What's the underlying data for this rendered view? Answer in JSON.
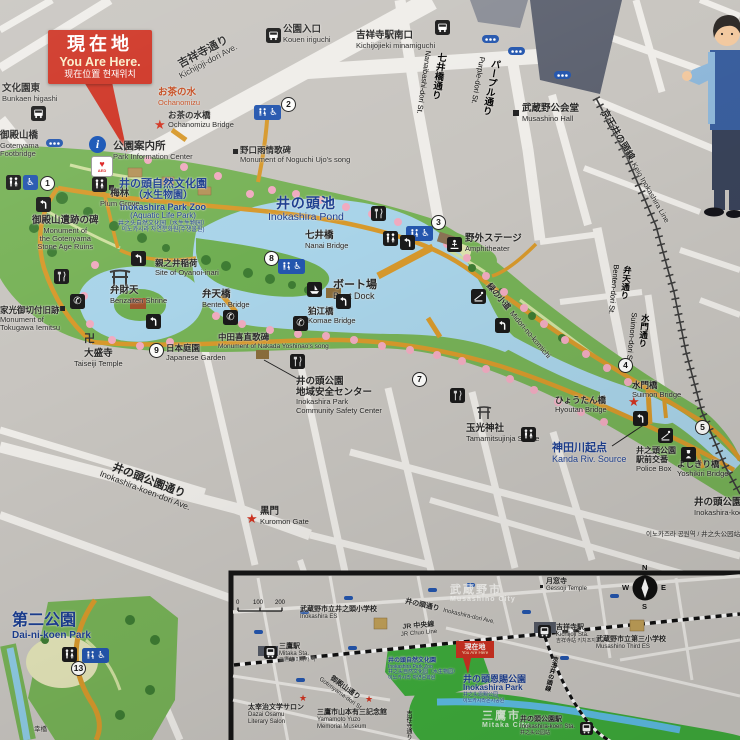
{
  "colors": {
    "background_gray": "#c8c5c0",
    "street_white": "#efede9",
    "park_green": "#77b257",
    "pond_blue": "#a9d4e9",
    "path_orange": "#d7992c",
    "accent_red": "#ce3222",
    "navy_text": "#1c3e90",
    "icon_blue": "#2456ae",
    "inset_green": "#3fae3c"
  },
  "you_are_here": {
    "ja": "現在地",
    "en": "You Are Here.",
    "sub": "现在位置  현재위치"
  },
  "icons": {
    "wheelchair": "♿",
    "info": "i",
    "phone": "✆",
    "star": "★",
    "manji": "卍",
    "heart": "♥",
    "aed_label": "AED"
  },
  "markers": {
    "n1": "1",
    "n2": "2",
    "n3": "3",
    "n4": "4",
    "n5": "5",
    "n7": "7",
    "n8": "8",
    "n9": "9",
    "n13": "13"
  },
  "labels": {
    "bunkaen_higashi": {
      "ja": "文化園東",
      "en": "Bunkaen higashi"
    },
    "kichijoji_dori": {
      "ja": "吉祥寺通り",
      "en": "Kichijoji-dori Ave."
    },
    "kouen_iriguchi": {
      "ja": "公園入口",
      "en": "Kouen iriguchi"
    },
    "kichijojieki_minamiguchi": {
      "ja": "吉祥寺駅南口",
      "en": "Kichijojieki minamiguchi"
    },
    "nanaibashi_dori": {
      "ja": "七井橋通り",
      "en": "Nanaibashi-dori St."
    },
    "purple_dori": {
      "ja": "パープル通り",
      "en": "Purple-dori St."
    },
    "musashino_hall": {
      "ja": "武蔵野公会堂",
      "en": "Musashino Hall"
    },
    "keio_line": {
      "ja": "京王井の頭線",
      "en": "Keio Inokashira Line"
    },
    "ochanomizu": {
      "ja": "お茶の水",
      "en": "Ochanomizu"
    },
    "ochanomizu_bridge": {
      "ja": "お茶の水橋",
      "en": "Ochanomizu Bridge"
    },
    "gotenyama_footbridge": {
      "ja": "御殿山橋",
      "en1": "Gotenyama",
      "en2": "Footbridge"
    },
    "park_info": {
      "ja": "公園案内所",
      "en": "Park Information Center"
    },
    "noguchi": {
      "ja": "野口雨情歌碑",
      "en": "Monument of Noguchi Ujo's song"
    },
    "zoo": {
      "ja1": "井の頭自然文化園",
      "ja2": "（水生物園）",
      "en1": "Inokashira Park Zoo",
      "en2": "(Aquatic Life Park)",
      "zh": "井之头自然文化园（水生生物园）",
      "ko": "이노카시라 자연문화원(수생물원)"
    },
    "pond": {
      "ja": "井の頭池",
      "en": "Inokashira Pond"
    },
    "plum_grove": {
      "ja": "梅林",
      "en": "Plum Grove"
    },
    "gotenyama_ruins": {
      "ja": "御殿山遺跡の碑",
      "en1": "Monument of",
      "en2": "the Gotenyama",
      "en3": "Stone Age Ruins"
    },
    "oyanoi": {
      "ja": "親之井稲荷",
      "en": "Site of Oyanoi-inari"
    },
    "nanai_bridge": {
      "ja": "七井橋",
      "en": "Nanai Bridge"
    },
    "amphitheater": {
      "ja": "野外ステージ",
      "en": "Amphitheater"
    },
    "benzaiten": {
      "ja": "弁財天",
      "en": "Benzaiten Shrine"
    },
    "benten_bridge": {
      "ja": "弁天橋",
      "en": "Benten Bridge"
    },
    "boat_dock": {
      "ja": "ボート場",
      "en": "Boat Dock"
    },
    "komae_bridge": {
      "ja": "狛江橋",
      "en": "Komae Bridge"
    },
    "midori_no_komichi": {
      "ja": "緑の小道",
      "en": "Midori-no-komichi"
    },
    "iemitsu": {
      "ja": "家光御切付旧跡",
      "en1": "Monument of",
      "en2": "Tokugawa Iemitsu"
    },
    "nakada": {
      "ja": "中田喜直歌碑",
      "en": "Monument of Nakada Yoshinao's song"
    },
    "taiseiji": {
      "ja": "大盛寺",
      "en": "Taiseiji Temple"
    },
    "japanese_garden": {
      "ja": "日本庭園",
      "en": "Japanese Garden"
    },
    "benten_dori": {
      "ja": "弁天通り",
      "en": "Benten-dori St."
    },
    "suimon_dori": {
      "ja": "水門通り",
      "en": "Suimon-dori St."
    },
    "safety_center": {
      "ja1": "井の頭公園",
      "ja2": "地域安全センター",
      "en1": "Inokashira Park",
      "en2": "Community Safety Center"
    },
    "tamamitsu": {
      "ja": "玉光神社",
      "en": "Tamamitsujinja Shrine"
    },
    "hyoutan_bridge": {
      "ja": "ひょうたん橋",
      "en": "Hyoutan Bridge"
    },
    "suimon_bridge": {
      "ja": "水門橋",
      "en": "Suimon Bridge"
    },
    "kanda_source": {
      "ja": "神田川起点",
      "en": "Kanda Riv. Source"
    },
    "police_box": {
      "ja1": "井之頭公園",
      "ja2": "駅前交番",
      "en": "Police Box"
    },
    "yoshikiri_bridge": {
      "ja": "よしきり橋",
      "en": "Yoshikiri Bridge"
    },
    "koen_dori": {
      "ja": "井の頭公園通り",
      "en": "Inokashira-koen-dori Ave."
    },
    "kuromon": {
      "ja": "黒門",
      "en": "Kuromon Gate"
    },
    "inokashira_koen_sta": {
      "ja": "井の頭公園駅",
      "en": "Inokashira-koen Sta.",
      "sub": "이노카즈라 공원역 / 井之头公园站"
    },
    "dai_ni_koen": {
      "ja": "第二公園",
      "en": "Dai-ni-koen Park"
    },
    "sachibashi": {
      "ja": "幸橋"
    }
  },
  "inset": {
    "scale": {
      "t0": "0",
      "t1": "100",
      "t2": "200"
    },
    "compass": {
      "n": "N",
      "e": "E",
      "s": "S",
      "w": "W"
    },
    "labels": {
      "inokashira_es": {
        "ja": "武蔵野市立井之頭小学校",
        "en": "Inokashira ES"
      },
      "inokashira_dori": {
        "ja": "井の頭通り",
        "en": "Inokashira-dori Ave."
      },
      "jr_chuo": {
        "ja": "JR 中央線",
        "en": "JR Chuo Line"
      },
      "mitaka_sta": {
        "ja": "三鷹駅",
        "en": "Mitaka Sta.",
        "sub": "三鷹站 미타카 역"
      },
      "gotenyama_dori": {
        "ja": "御殿山通り",
        "en": "Gotenyama-dori St."
      },
      "zoo": {
        "ja": "井の頭自然文化園",
        "en": "Inokashira Park Zoo",
        "zh": "井之头自然文化园（水生物园）",
        "ko": "이노카시라 자연문화원"
      },
      "dazai": {
        "ja": "太宰治文学サロン",
        "en1": "Dazai Osamu",
        "en2": "Literary Salon"
      },
      "yamamoto": {
        "ja": "三鷹市山本有三記念館",
        "en1": "Yamamoto Yuzo",
        "en2": "Memorial Museum"
      },
      "gessoji": {
        "ja": "月窓寺",
        "en": "Gessoji Temple"
      },
      "kichijoji_sta": {
        "ja": "吉祥寺駅",
        "en": "Kichijoji Sta.",
        "sub": "吉祥寺站 키치조지 역"
      },
      "musashino_third": {
        "ja": "武蔵野市立第三小学校",
        "en": "Musashino Third ES"
      },
      "inokashira_park": {
        "ja": "井の頭恩賜公園",
        "en": "Inokashira Park",
        "zh": "井之头恩赐公园",
        "ko": "이노카시라온시공원"
      },
      "mitaka_city": {
        "ja": "三鷹市",
        "en": "Mitaka City"
      },
      "musashino_city": {
        "ja": "武蔵野市",
        "en": "Musashino City"
      },
      "inokashira_koen_sta": {
        "ja": "井の頭公園駅",
        "en": "Inokashira-koen Sta.",
        "sub": "井之头公园站"
      },
      "keio_line": {
        "ja": "京王井の頭線"
      },
      "kichijoji_dori": {
        "ja": "吉祥寺通り"
      },
      "you_are_here": {
        "ja": "現在地",
        "en": "You Are Here"
      }
    }
  }
}
